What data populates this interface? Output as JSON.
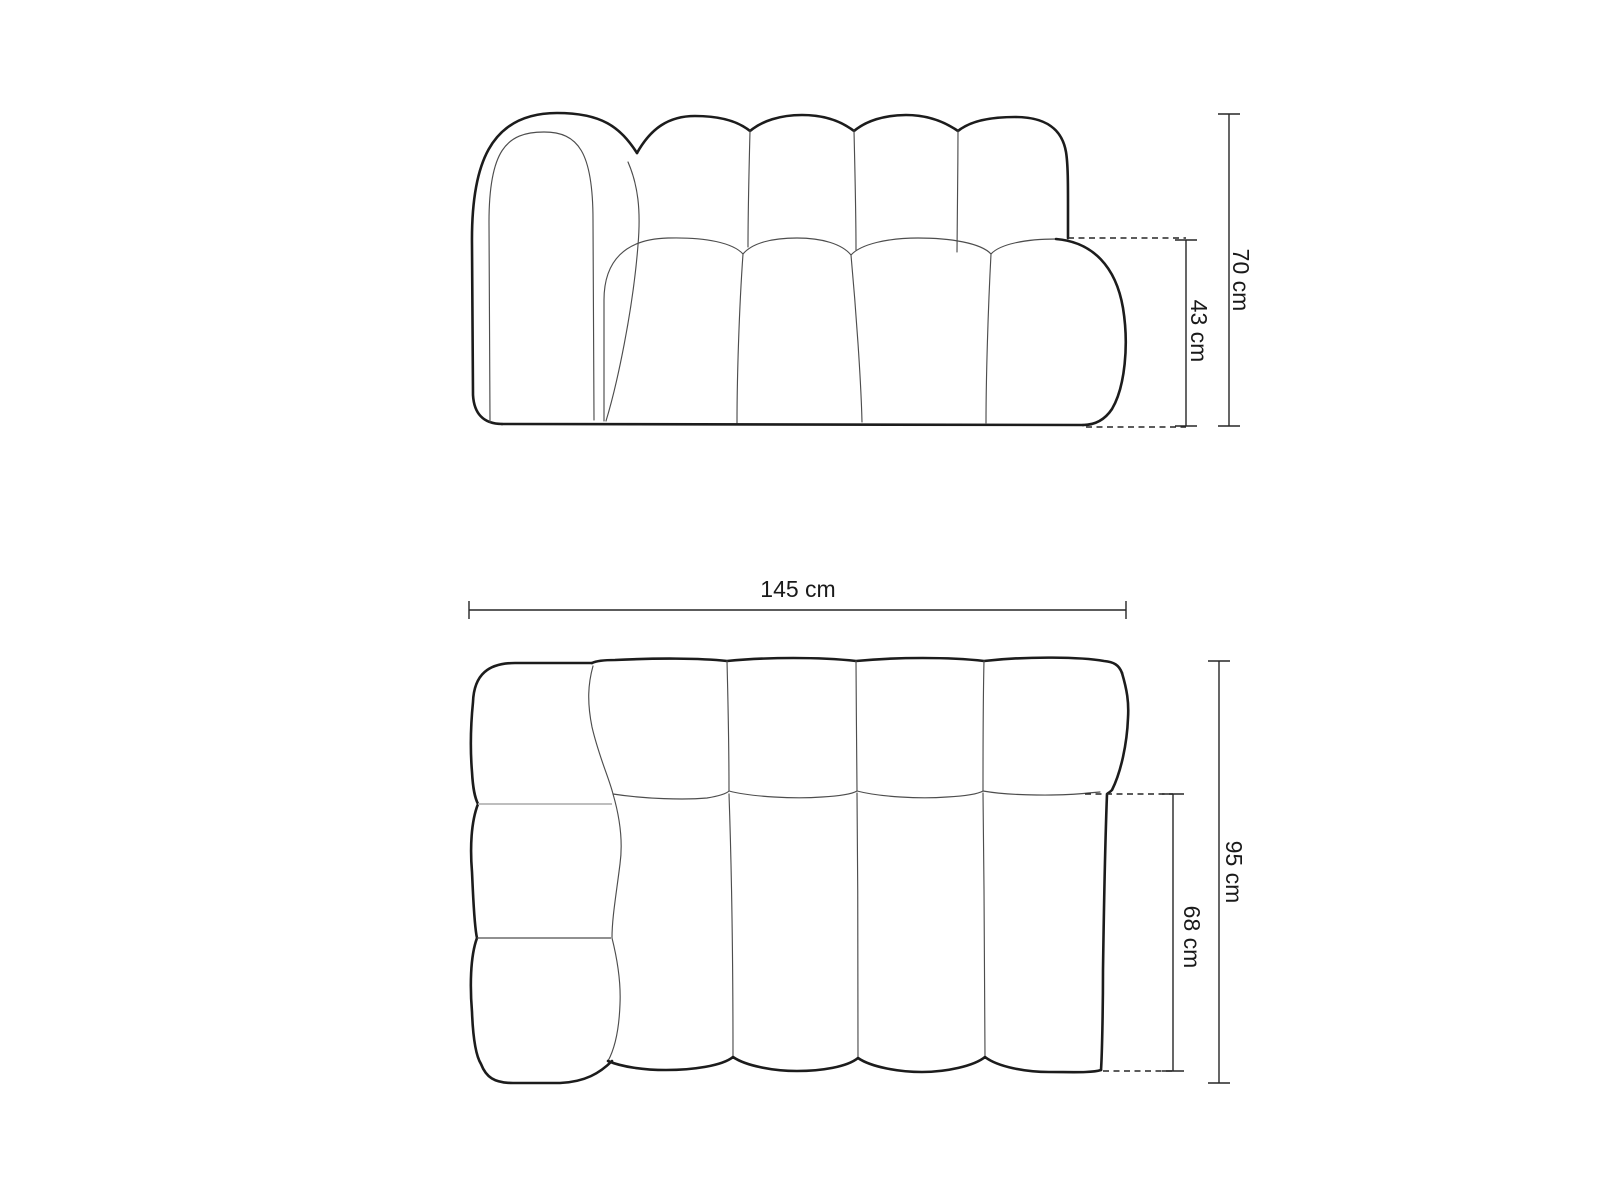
{
  "figure": {
    "kind": "sofa-module-dimension-drawing",
    "front_view": {
      "total_height_label": "70 cm",
      "seat_height_label": "43 cm"
    },
    "top_view": {
      "total_width_label": "145 cm",
      "total_depth_label": "95 cm",
      "seat_depth_label": "68 cm"
    },
    "colors": {
      "outline": "#1c1c1c",
      "thin": "#4d4d4d",
      "divider": "#b5b5b5",
      "dimension": "#262626",
      "text": "#1a1a1a",
      "background": "#ffffff"
    }
  }
}
